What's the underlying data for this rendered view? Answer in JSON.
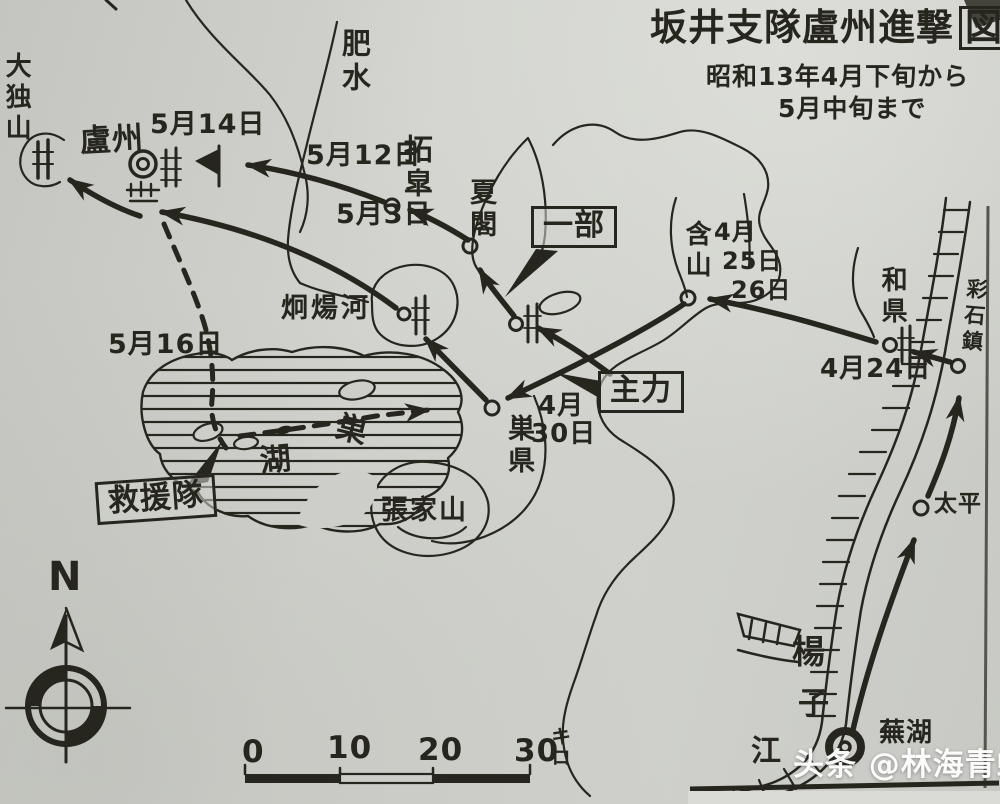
{
  "colors": {
    "paper": "#cdcec9",
    "ink": "#26261f",
    "watermark": "#ffffff"
  },
  "title": {
    "main": "坂井支隊盧州進撃",
    "boxed_char": "図",
    "subtitle1": "昭和13年4月下旬から",
    "subtitle2": "5月中旬まで"
  },
  "places": {
    "daitokuzan": "大独山",
    "rozhou": "盧州",
    "hisui": "肥水",
    "takuko": "拓皐",
    "kakaku": "夏閣",
    "ganzan": "含山",
    "waken": "和県",
    "saisekichin": "彩石鎮",
    "keiyoga": "炯煬河",
    "lake_so": "巣",
    "lake_ko": "湖",
    "soken": "巣県",
    "chokazan": "張家山",
    "taihei": "太平",
    "yangtze_1": "楊",
    "yangtze_2": "子",
    "yangtze_3": "江",
    "buko": "蕪湖"
  },
  "dates": {
    "d0514": "5月14日",
    "d0512": "5月12日",
    "d0503": "5月3日",
    "d0425_m": "4月",
    "d0425_a": "25日",
    "d0425_b": "26日",
    "d0424": "4月24日",
    "d0516": "5月16日",
    "d0430_m": "4月",
    "d0430_d": "30日"
  },
  "units": {
    "ichibu": "一部",
    "shuryoku": "主力",
    "kyuentai": "救援隊"
  },
  "compass": {
    "north": "N"
  },
  "scale": {
    "t0": "0",
    "t1": "10",
    "t2": "20",
    "t3": "30",
    "unit": "キロ"
  },
  "watermark": "头条 @林海青蛙"
}
